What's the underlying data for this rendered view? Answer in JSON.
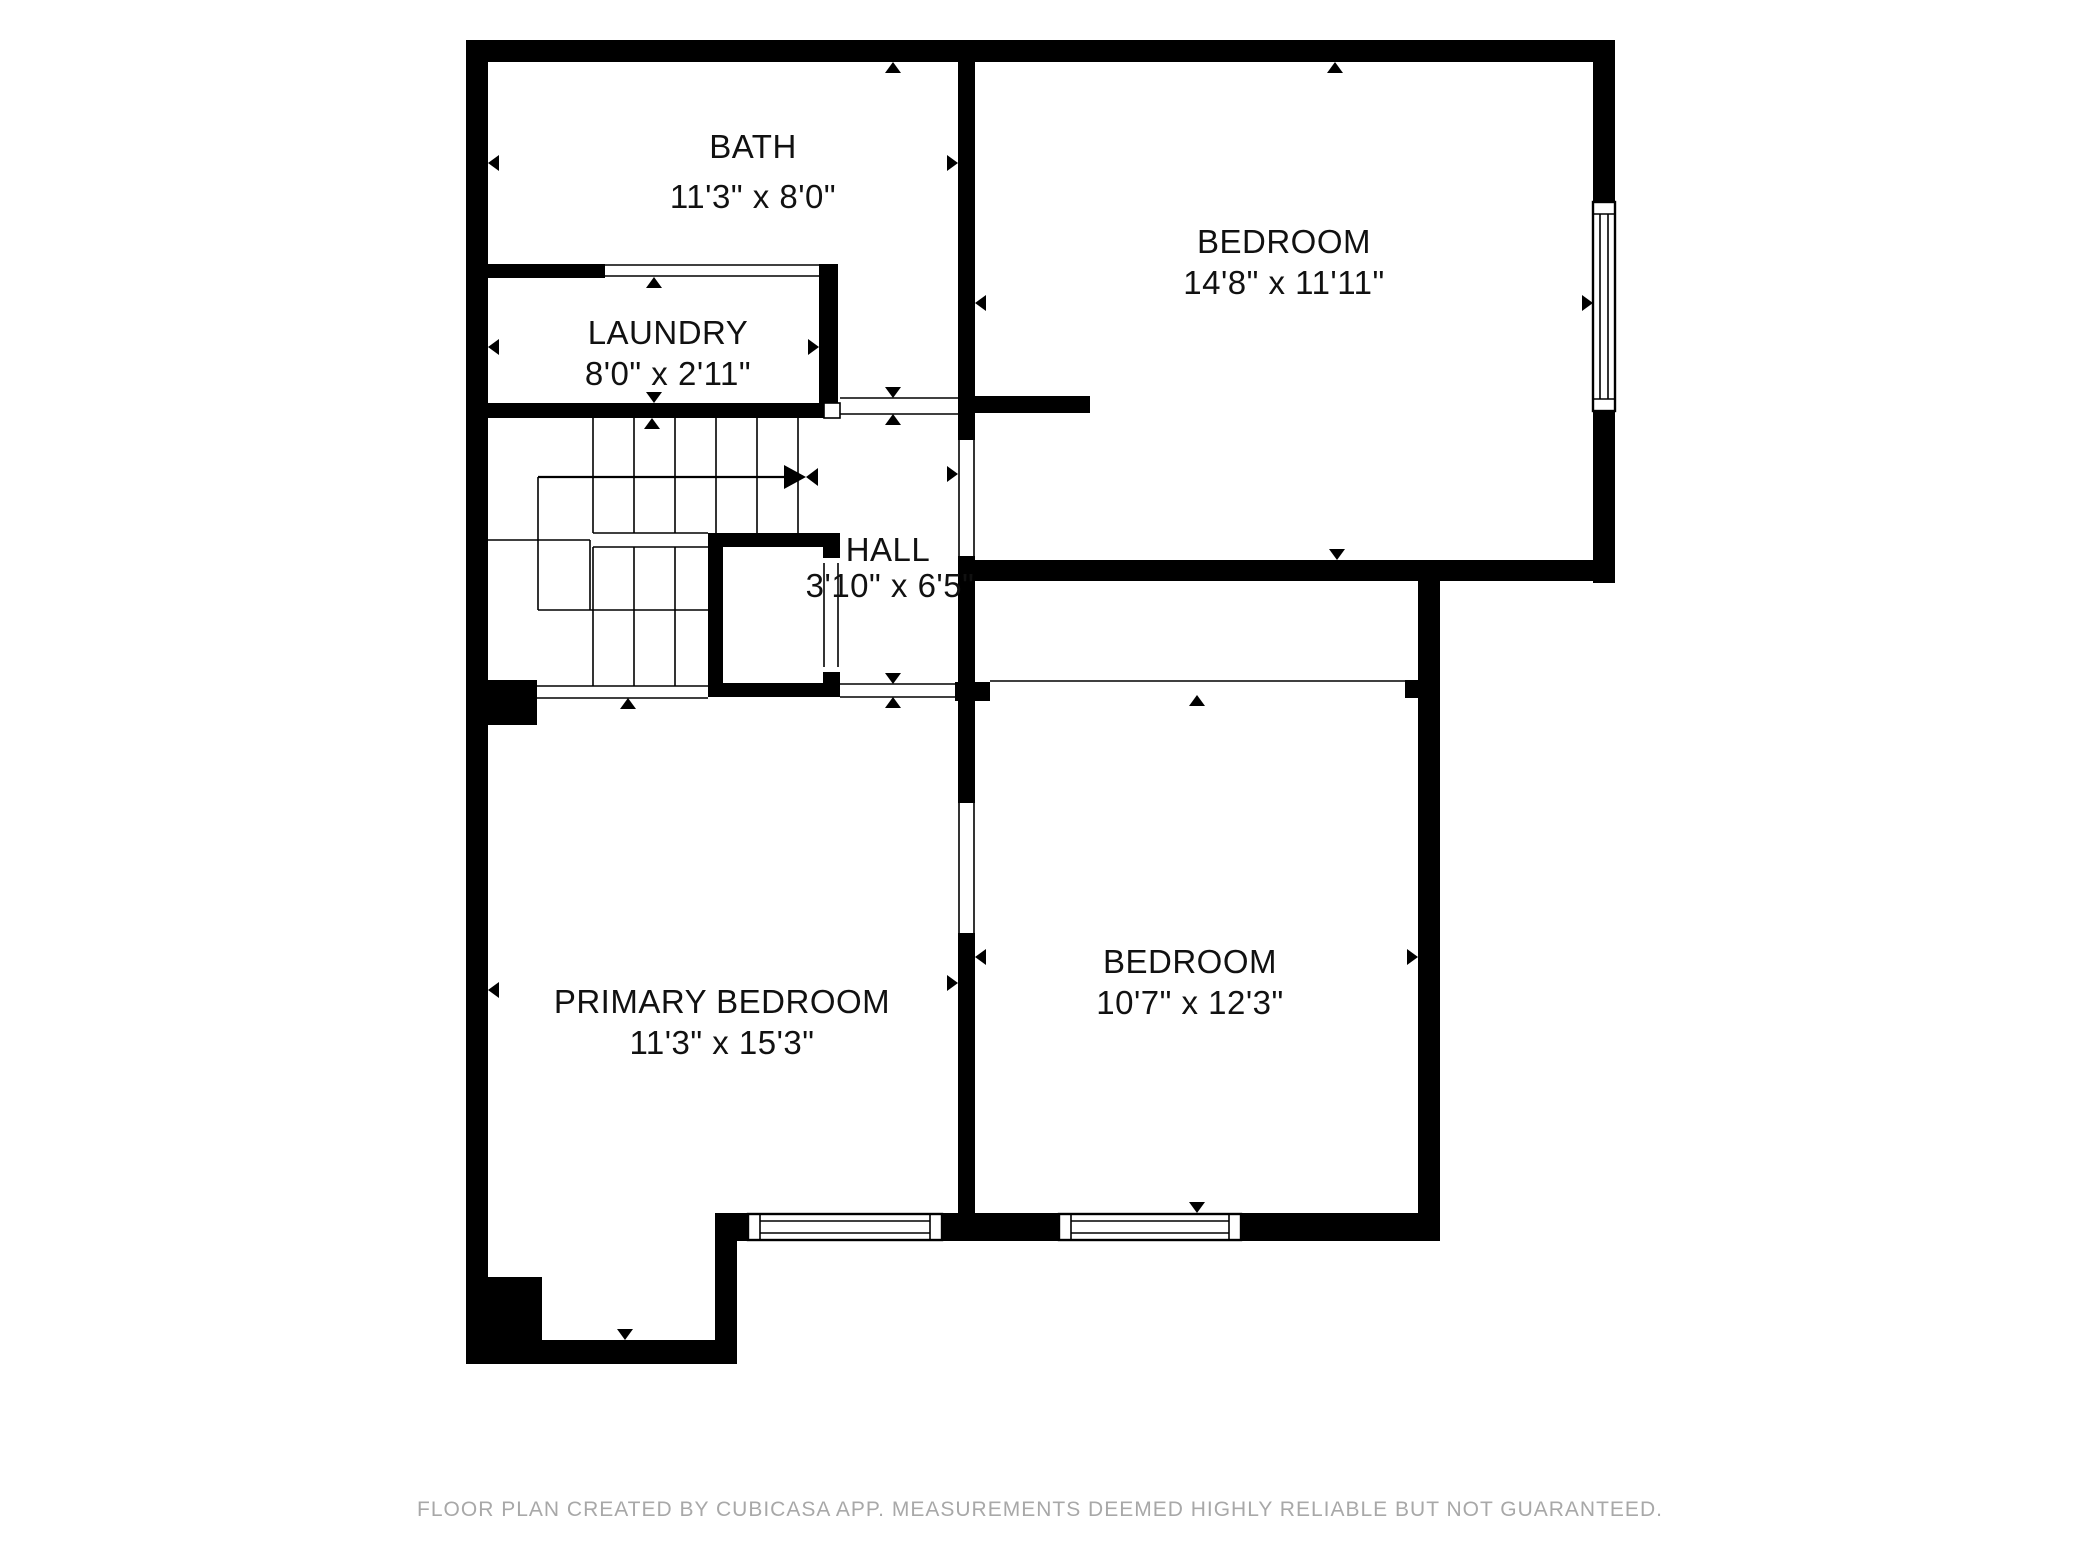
{
  "colors": {
    "wall": "#000000",
    "line": "#000000",
    "background": "#ffffff",
    "label_text": "#111111",
    "footer_text": "#a8a8a8"
  },
  "rooms": [
    {
      "id": "bath",
      "name": "BATH",
      "dimensions": "11'3\" x 8'0\""
    },
    {
      "id": "laundry",
      "name": "LAUNDRY",
      "dimensions": "8'0\" x 2'11\""
    },
    {
      "id": "bedroom-top",
      "name": "BEDROOM",
      "dimensions": "14'8\" x 11'11\""
    },
    {
      "id": "hall",
      "name": "HALL",
      "dimensions": "3'10\" x 6'5\""
    },
    {
      "id": "primary-bedroom",
      "name": "PRIMARY BEDROOM",
      "dimensions": "11'3\" x 15'3\""
    },
    {
      "id": "bedroom-bottom",
      "name": "BEDROOM",
      "dimensions": "10'7\" x 12'3\""
    }
  ],
  "footer": "FLOOR PLAN CREATED BY CUBICASA APP. MEASUREMENTS DEEMED HIGHLY RELIABLE BUT NOT GUARANTEED."
}
